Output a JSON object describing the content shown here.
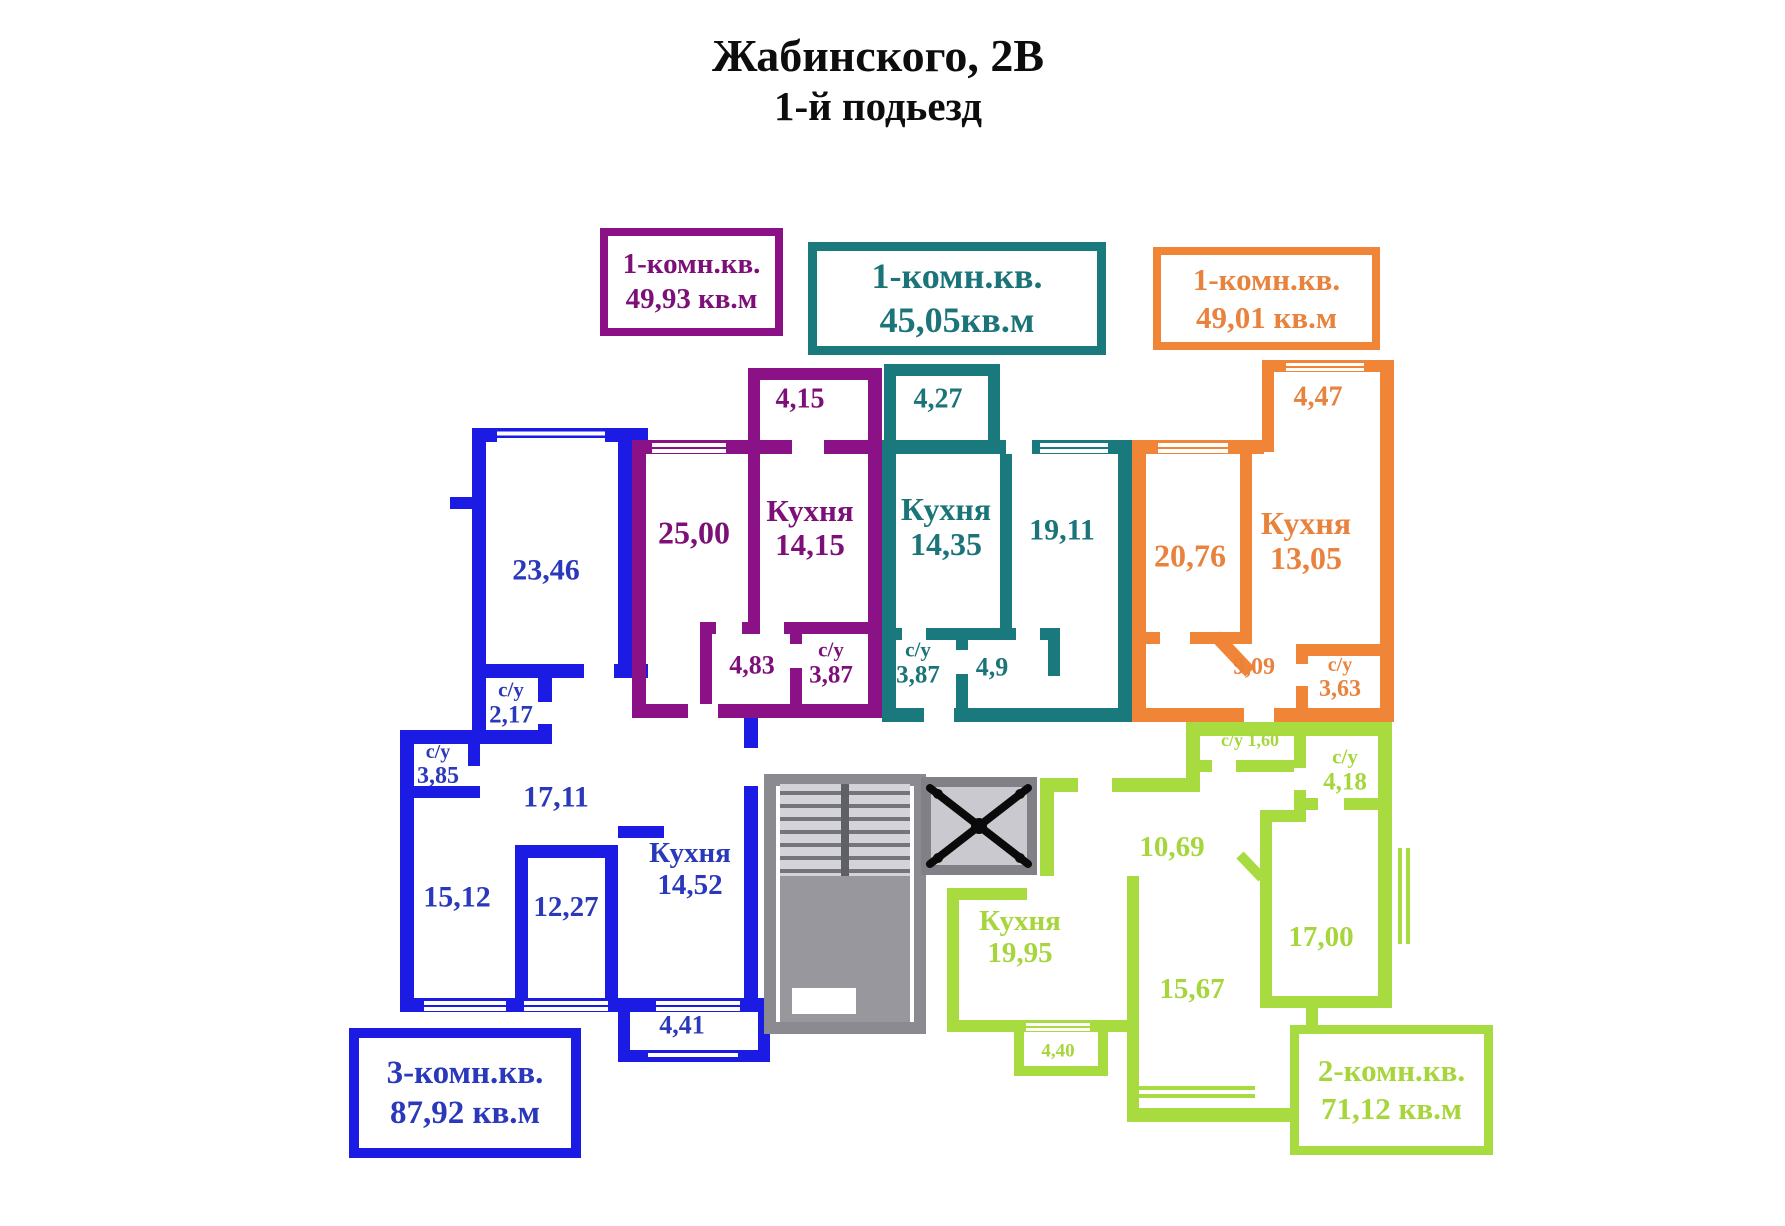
{
  "title": {
    "line1": "Жабинского, 2В",
    "line2": "1-й подьезд"
  },
  "legend": {
    "purple": {
      "type": "1-комн.кв.",
      "area": "49,93 кв.м"
    },
    "teal": {
      "type": "1-комн.кв.",
      "area": "45,05кв.м"
    },
    "orange": {
      "type": "1-комн.кв.",
      "area": "49,01 кв.м"
    },
    "blue": {
      "type": "3-комн.кв.",
      "area": "87,92 кв.м"
    },
    "green": {
      "type": "2-комн.кв.",
      "area": "71,12 кв.м"
    }
  },
  "colors": {
    "purple_wall": "#8a1186",
    "purple_text": "#7d1078",
    "teal_wall": "#19797c",
    "teal_text": "#1b7478",
    "orange_wall": "#f08437",
    "orange_text": "#e8823c",
    "blue_wall": "#1b1be4",
    "blue_text": "#2a38bb",
    "green_wall": "#a8db40",
    "green_text": "#a6d63c",
    "stairs_gray": "#8a8a90",
    "elevator_fill": "#c9c9cf",
    "title_black": "#0d0d0d"
  },
  "apartments": {
    "blue": {
      "rooms": [
        {
          "value": "23,46"
        },
        {
          "name": "с/у",
          "value": "2,17"
        },
        {
          "name": "с/у",
          "value": "3,85"
        },
        {
          "value": "17,11"
        },
        {
          "value": "15,12"
        },
        {
          "value": "12,27"
        },
        {
          "name": "Кухня",
          "value": "14,52"
        },
        {
          "value": "4,41"
        }
      ]
    },
    "purple": {
      "rooms": [
        {
          "value": "4,15"
        },
        {
          "value": "25,00"
        },
        {
          "name": "Кухня",
          "value": "14,15"
        },
        {
          "value": "4,83"
        },
        {
          "name": "с/у",
          "value": "3,87"
        }
      ]
    },
    "teal": {
      "rooms": [
        {
          "value": "4,27"
        },
        {
          "name": "Кухня",
          "value": "14,35"
        },
        {
          "value": "19,11"
        },
        {
          "name": "с/у",
          "value": "3,87"
        },
        {
          "value": "4,9"
        }
      ]
    },
    "orange": {
      "rooms": [
        {
          "value": "4,47"
        },
        {
          "value": "20,76"
        },
        {
          "name": "Кухня",
          "value": "13,05"
        },
        {
          "value": "9,09"
        },
        {
          "name": "с/у",
          "value": "3,63"
        }
      ]
    },
    "green": {
      "rooms": [
        {
          "name": "с/у",
          "value": "1,60"
        },
        {
          "name": "с/у",
          "value": "4,18"
        },
        {
          "value": "10,69"
        },
        {
          "value": "17,00"
        },
        {
          "name": "Кухня",
          "value": "19,95"
        },
        {
          "value": "15,67"
        },
        {
          "value": "4,40"
        }
      ]
    }
  }
}
